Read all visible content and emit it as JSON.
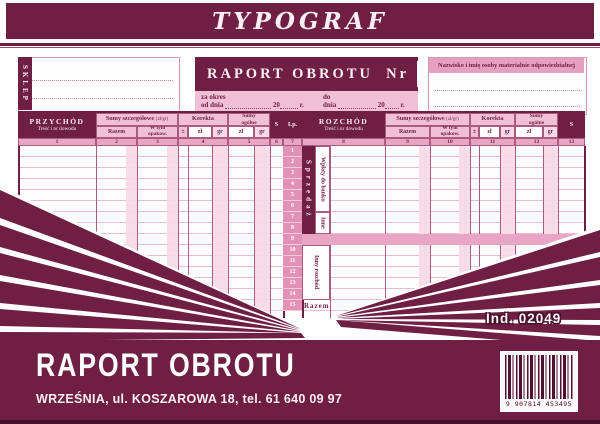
{
  "banner": {
    "brand": "TYPOGRAF"
  },
  "header": {
    "sklep_label": "SKLEP",
    "title": "RAPORT OBROTU",
    "nr_label": "Nr",
    "za_okres": "za okres",
    "od_dnia": "od dnia",
    "do_label": "do",
    "dnia": "dnia",
    "year": "20",
    "r": "r.",
    "responsible": "Nazwisko i imię osoby materialnie odpowiedzialnej"
  },
  "table": {
    "left_title": "PRZYCHÓD",
    "right_title": "ROZCHÓD",
    "subtitle": "Treść i nr dowodu",
    "sumy_szczegolowe": "Sumy szczegółowe",
    "zl_gr_paren": "(zł/gr)",
    "razem": "Razem",
    "w_tym": "W tym",
    "opakow": "opakow.",
    "korekta": "Korekta",
    "pm": "±",
    "zl": "zł",
    "gr": "gr",
    "sumy": "Sumy",
    "ogolne": "ogólne",
    "s": "S",
    "lp": "Lp.",
    "left_col_numbers": [
      "1",
      "2",
      "3",
      "4",
      "5",
      "6",
      "7"
    ],
    "right_col_numbers": [
      "8",
      "9",
      "10",
      "11",
      "12",
      "13"
    ],
    "row_numbers": [
      "1",
      "2",
      "3",
      "4",
      "5",
      "6",
      "7",
      "8",
      "9",
      "10",
      "11",
      "12",
      "13",
      "14",
      "15"
    ],
    "sections": {
      "sprzedaz": "Sprzedaż",
      "wplaty_do_banku": "Wpłaty do banku",
      "inne": "Inne",
      "inny_rozchod": "Inny rozchód",
      "razem_row": "Razem"
    }
  },
  "ind_number": "Ind. 02049",
  "footer": {
    "product_title": "RAPORT OBROTU",
    "address": "WRZEŚNIA,  ul. KOSZAROWA 18, tel. 61 640 09 97",
    "barcode_number": "9 907814 453495"
  },
  "colors": {
    "maroon": "#6f1f44",
    "pink_header": "#f1c0d6",
    "pink_medium": "#e9a6c4",
    "pink_stripe": "#f7d9e7",
    "paper_white": "#fffdfe"
  }
}
